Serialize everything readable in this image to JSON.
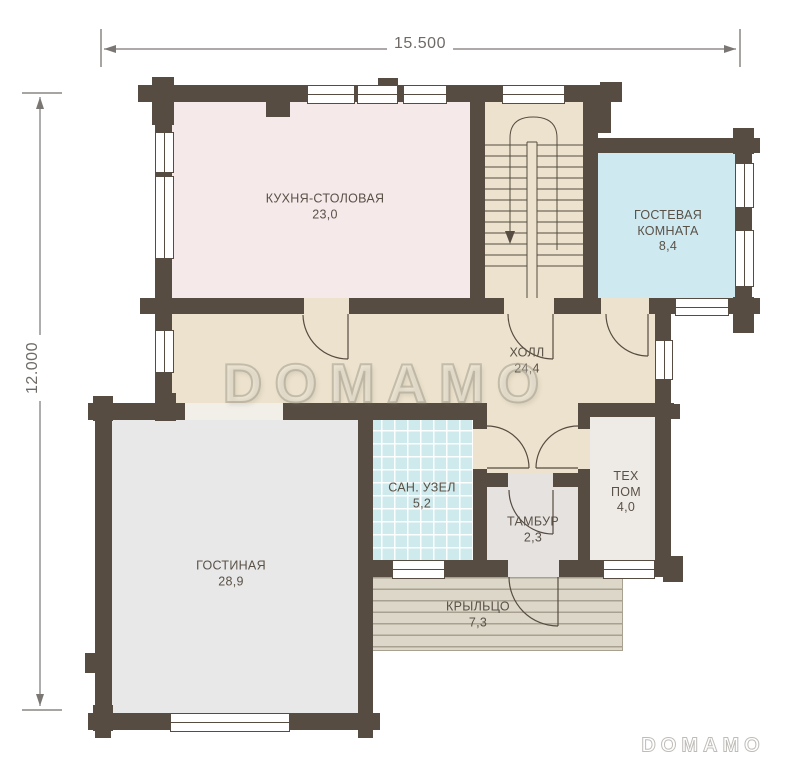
{
  "dimensions": {
    "width_label": "15.500",
    "height_label": "12.000"
  },
  "rooms": [
    {
      "name": "КУХНЯ-СТОЛОВАЯ",
      "area": "23,0"
    },
    {
      "name": "ХОЛЛ",
      "area": "24,4"
    },
    {
      "name": "ГОСТЕВАЯ КОМНАТА",
      "area": "8,4"
    },
    {
      "name": "САН. УЗЕЛ",
      "area": "5,2"
    },
    {
      "name": "ТАМБУР",
      "area": "2,3"
    },
    {
      "name": "ТЕХ ПОМ",
      "area": "4,0"
    },
    {
      "name": "ГОСТИНАЯ",
      "area": "28,9"
    },
    {
      "name": "КРЫЛЬЦО",
      "area": "7,3"
    }
  ],
  "watermark": {
    "center": "DOMAMO",
    "corner": "DOMAMO"
  },
  "colors": {
    "wall": "#564c41",
    "kitchen": "#f5e9e9",
    "hall": "#ece2cd",
    "guest": "#cfe9f0",
    "tile": "#cfeaec",
    "living": "#e8e8e9",
    "tambur": "#e5e2df",
    "tech": "#eeeae5",
    "porch": "#dcd7c9",
    "porch_stripe": "#a8a191",
    "passage": "#f2efe9",
    "dim": "#6f6a66",
    "label": "#5a5147",
    "watermark": "#b9b1a0"
  }
}
